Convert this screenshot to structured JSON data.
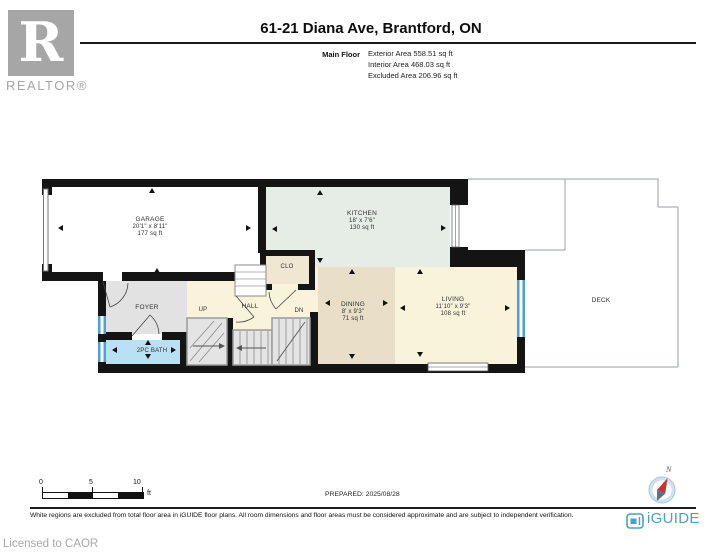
{
  "header": {
    "realtor_logo_letter": "R",
    "realtor_logo_text": "REALTOR®",
    "title": "61-21 Diana Ave, Brantford, ON",
    "floor_label": "Main Floor",
    "stats": [
      "Exterior Area 558.51 sq ft",
      "Interior Area 468.03 sq ft",
      "Excluded Area 206.96 sq ft"
    ]
  },
  "plan": {
    "rooms": {
      "garage": {
        "name": "GARAGE",
        "dims": "20'1\" x 8'11\"",
        "area": "177 sq ft"
      },
      "kitchen": {
        "name": "KITCHEN",
        "dims": "18' x 7'6\"",
        "area": "130 sq ft"
      },
      "dining": {
        "name": "DINING",
        "dims": "8' x 9'3\"",
        "area": "71 sq ft"
      },
      "living": {
        "name": "LIVING",
        "dims": "11'10\" x 9'3\"",
        "area": "108 sq ft"
      },
      "deck": {
        "name": "DECK"
      },
      "foyer": {
        "name": "FOYER"
      },
      "hall": {
        "name": "HALL"
      },
      "closet": {
        "name": "CLO"
      },
      "bath": {
        "name": "2PC BATH"
      },
      "stairs_up": {
        "name": "UP"
      },
      "stairs_down": {
        "name": "DN"
      }
    }
  },
  "scale_bar": {
    "ticks": [
      "0",
      "5",
      "10"
    ],
    "unit": "ft"
  },
  "compass": {
    "north_label": "N"
  },
  "footer": {
    "prepared": "PREPARED: 2025/08/28",
    "disclaimer": "White regions are excluded from total floor area in iGUIDE floor plans. All room dimensions and floor areas must be considered approximate and are subject to independent verification.",
    "licensed": "Licensed to CAOR",
    "brand": "iGUIDE"
  },
  "colors": {
    "wall": "#141414",
    "kitchen_fill": "#e6ede6",
    "cream_fill": "#faf3dc",
    "dining_fill": "#e9dfc8",
    "foyer_fill": "#e2e2e2",
    "bath_fill": "#b9e0f3",
    "closet_fill": "#f0e7d3",
    "stair_fill": "#e4e4e4",
    "window_blue": "#4d9fd4",
    "brand_blue": "#4aa0cc"
  }
}
